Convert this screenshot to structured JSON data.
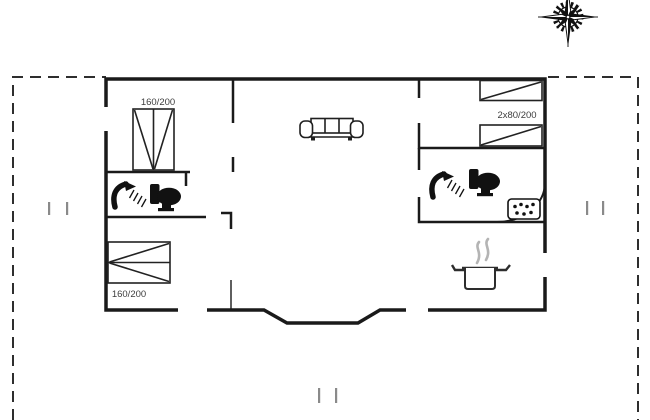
{
  "plan": {
    "type": "holiday-house-floor-plan",
    "rooms": {
      "bedroom_top_left": {
        "bed_label": "160/200"
      },
      "bedroom_top_right": {
        "bed_label": "2x80/200"
      },
      "bedroom_bottom_left": {
        "bed_label": "160/200"
      }
    },
    "icons": {
      "compass": "compass-rose-icon",
      "sofa": "sofa-icon",
      "shower_left": "shower-icon",
      "toilet_left": "toilet-icon",
      "shower_right": "shower-icon",
      "toilet_right": "toilet-icon",
      "stove": "stove-hob-icon",
      "pot": "cooking-pot-icon",
      "steam": "steam-icon"
    },
    "colors": {
      "background": "#ffffff",
      "wall": "#1a1a1a",
      "boundary_dash": "#2e2e2e",
      "label_text": "#3d3d3d",
      "steam": "#b4b4b4",
      "tick_mark": "#8a8a8a"
    }
  }
}
